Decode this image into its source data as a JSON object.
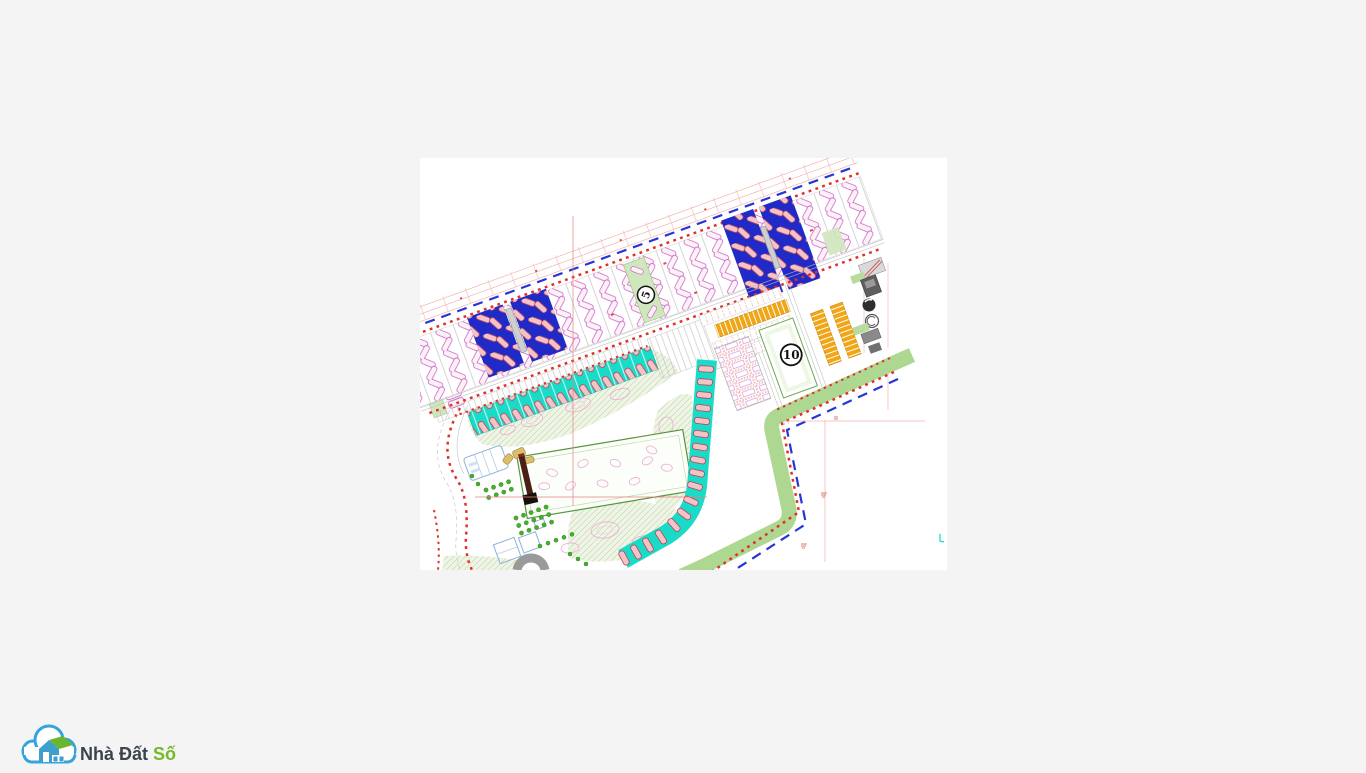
{
  "page": {
    "background": "#f4f4f4"
  },
  "drawing": {
    "title": "site-master-plan",
    "badges": {
      "block5": "5",
      "block10": "10"
    },
    "colors": {
      "boundary_red_dotted": "#e03028",
      "boundary_blue_dashed": "#2834d8",
      "block_blue": "#1f2ac8",
      "lot_strip_cyan": "#19dcc8",
      "lot_row_orange": "#f0a616",
      "green_buffer_strip": "#aed792",
      "park_green": "#eff5e6",
      "house_pill_pink": "#f2c4ca",
      "lot_outline_magenta": "#c964c9",
      "dimension_line_pink": "#f2b4b0",
      "sports_field_green": "#57953c"
    }
  },
  "logo": {
    "brand_primary": "Nhà Đất",
    "brand_accent": "Số"
  }
}
